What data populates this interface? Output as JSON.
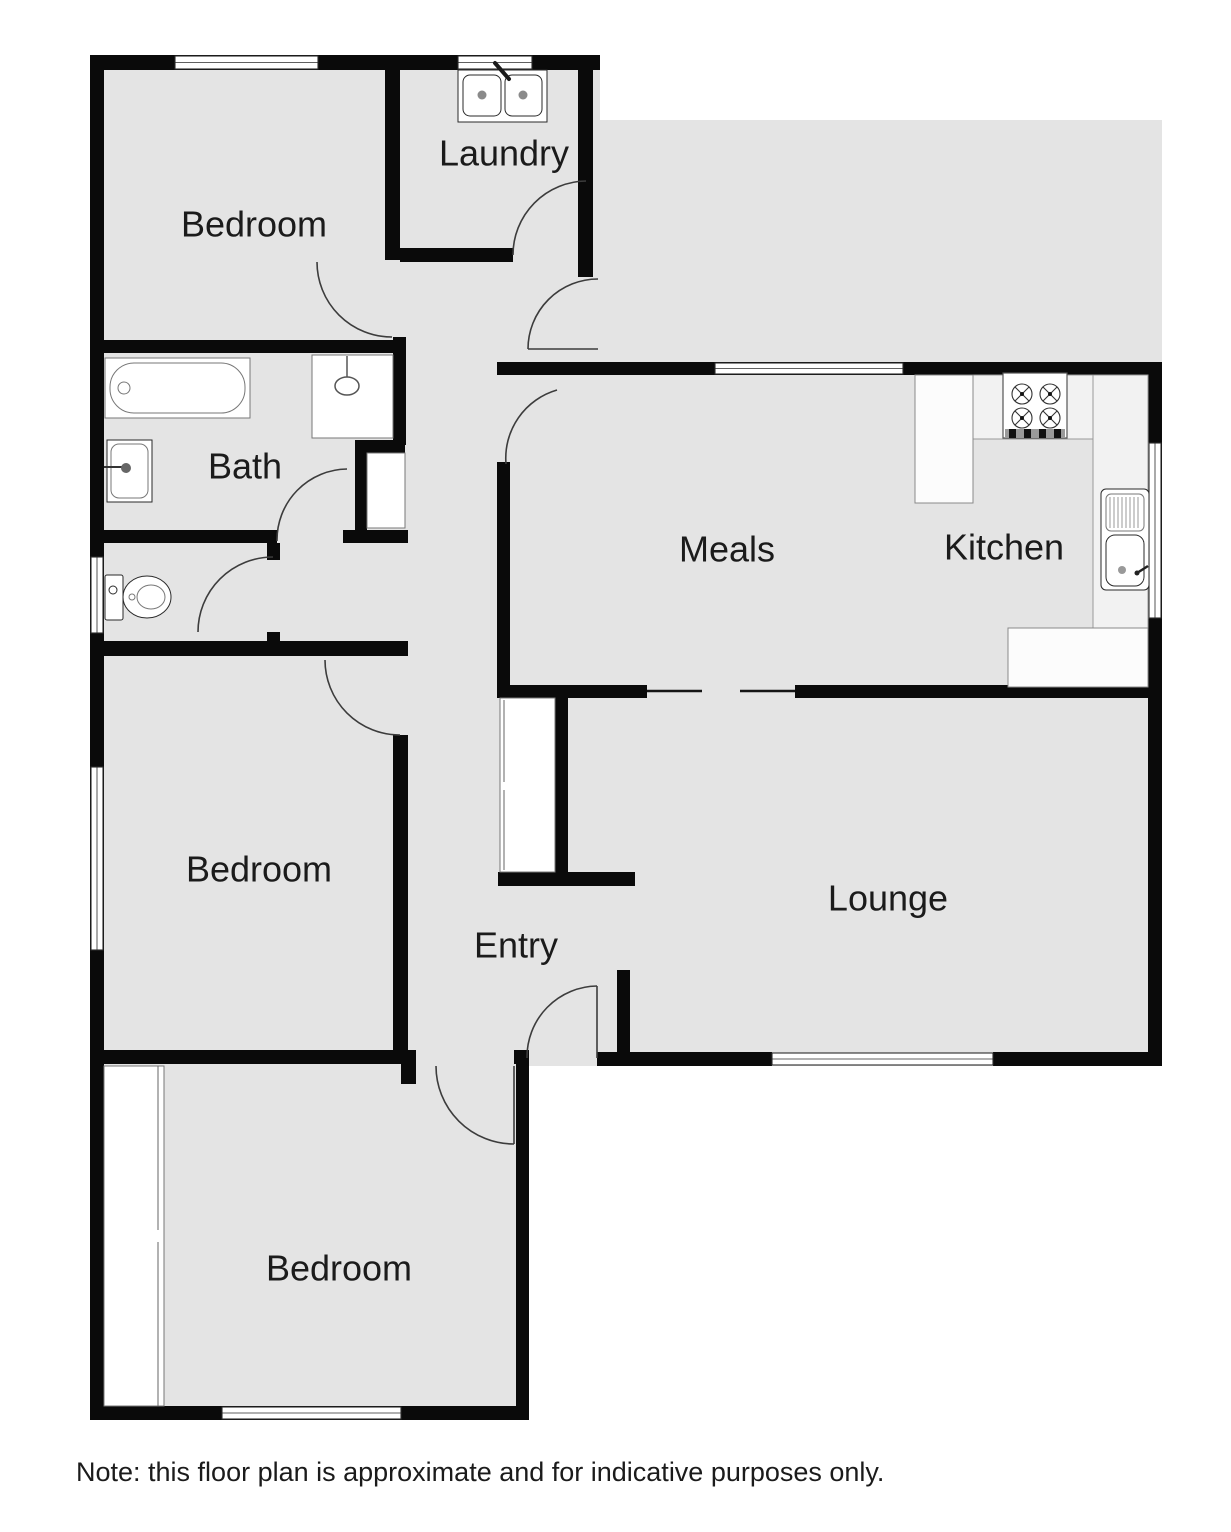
{
  "rooms": {
    "bedroom1": {
      "label": "Bedroom"
    },
    "laundry": {
      "label": "Laundry"
    },
    "bath": {
      "label": "Bath"
    },
    "meals": {
      "label": "Meals"
    },
    "kitchen": {
      "label": "Kitchen"
    },
    "bedroom2": {
      "label": "Bedroom"
    },
    "entry": {
      "label": "Entry"
    },
    "lounge": {
      "label": "Lounge"
    },
    "bedroom3": {
      "label": "Bedroom"
    }
  },
  "note": "Note: this floor plan is approximate and for indicative purposes only.",
  "colors": {
    "floor": "#e4e4e4",
    "wall": "#0a0a0a",
    "line": "#777777",
    "text": "#1b1b1b"
  },
  "fixtures": {
    "laundry": "double-laundry-sink",
    "bath": [
      "bathtub",
      "wall-basin",
      "shower-cubicle",
      "linen-cupboard"
    ],
    "wc": "toilet",
    "kitchen": [
      "four-burner-stove",
      "sink-with-drainboard",
      "bench-counters"
    ],
    "entry": "built-in-cupboard",
    "bedroom3": "built-in-robe"
  }
}
